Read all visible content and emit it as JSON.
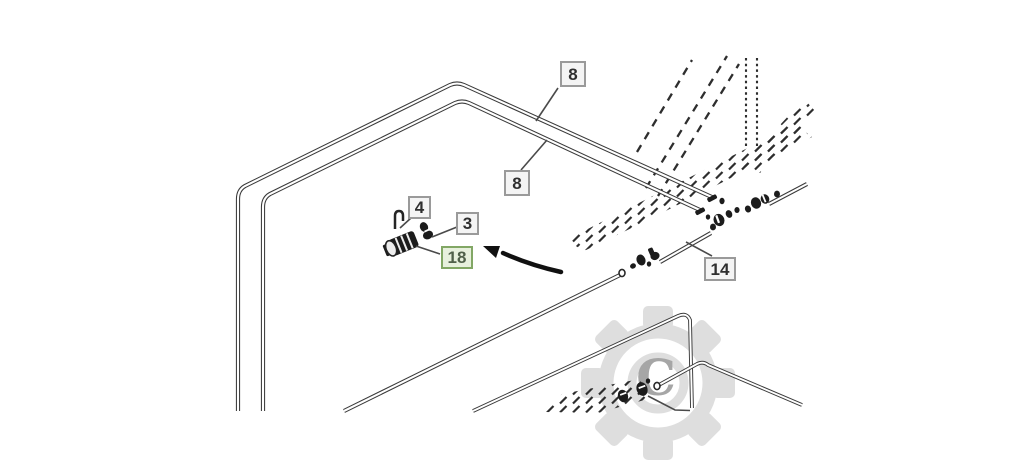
{
  "diagram": {
    "type": "exploded-parts-line-drawing",
    "callouts": [
      {
        "id": "callout-8-upper",
        "text": "8",
        "variant": "default",
        "points_to": "upper-routed-tube"
      },
      {
        "id": "callout-8-lower",
        "text": "8",
        "variant": "default",
        "points_to": "lower-routed-tube"
      },
      {
        "id": "callout-4",
        "text": "4",
        "variant": "default",
        "points_to": "retainer-clip"
      },
      {
        "id": "callout-3",
        "text": "3",
        "variant": "default",
        "points_to": "hose-clamp"
      },
      {
        "id": "callout-18",
        "text": "18",
        "variant": "highlighted",
        "points_to": "quick-connect-coupler"
      },
      {
        "id": "callout-14",
        "text": "14",
        "variant": "default",
        "points_to": "short-connector-tube"
      }
    ],
    "watermark": {
      "letter": "C",
      "shape": "gear"
    },
    "colors": {
      "line": "#3a3a3a",
      "fitting": "#1c1c1c",
      "leader": "#4a4a4a",
      "arrow": "#111111",
      "callout_border": "#9a9a9a",
      "callout_bg": "#f4f4f4",
      "callout_text": "#2f2f2f",
      "highlight_border": "#82a765",
      "highlight_bg": "#e7f0dd",
      "highlight_text": "#50604a",
      "watermark": "#dedede",
      "watermark_letter": "#a6a6a6",
      "canvas": "#ffffff"
    }
  }
}
